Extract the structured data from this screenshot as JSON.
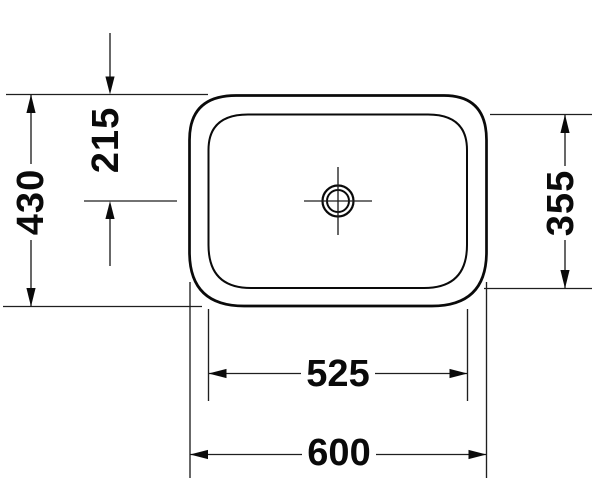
{
  "drawing": {
    "colors": {
      "line": "#0a0a0a",
      "dimension_line": "#1f1f1f",
      "background": "#ffffff"
    },
    "labels": {
      "overall_depth": "430",
      "drain_center_offset": "215",
      "inner_depth": "355",
      "inner_width": "525",
      "overall_width": "600"
    }
  }
}
